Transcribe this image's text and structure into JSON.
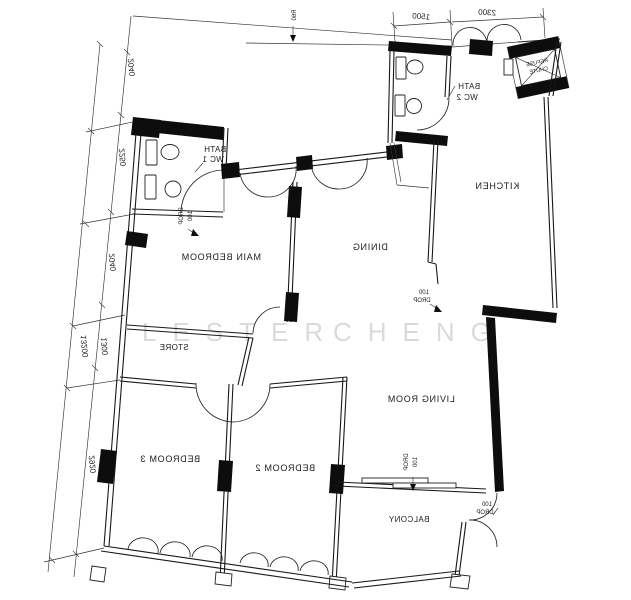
{
  "watermark": {
    "first": "LESTER",
    "second": "CHENG"
  },
  "rooms": {
    "main_bedroom": {
      "label": "MAIN BEDROOM"
    },
    "dining": {
      "label": "DINING"
    },
    "kitchen": {
      "label": "KITCHEN"
    },
    "living_room": {
      "label": "LIVING ROOM"
    },
    "store": {
      "label": "STORE"
    },
    "bedroom2": {
      "label": "BEDROOM 2"
    },
    "bedroom3": {
      "label": "BEDROOM 3"
    },
    "balcony": {
      "label": "BALCONY"
    },
    "bath1": {
      "line1": "BATH",
      "line2": "WC 1"
    },
    "bath2": {
      "line1": "BATH",
      "line2": "WC 2"
    },
    "refuse_chute": {
      "line1": "REFUSE",
      "line2": "CHUTE"
    }
  },
  "dimensions": {
    "top_left_width": "1500",
    "top_right_width": "2300",
    "radius_note": "R60",
    "left_total": "13200",
    "left_seg1": "2040",
    "left_seg2": "2250",
    "left_seg3": "2040",
    "left_seg4": "1300",
    "left_seg5": "2920"
  },
  "drop_note": {
    "value": "100",
    "word": "DROP"
  }
}
